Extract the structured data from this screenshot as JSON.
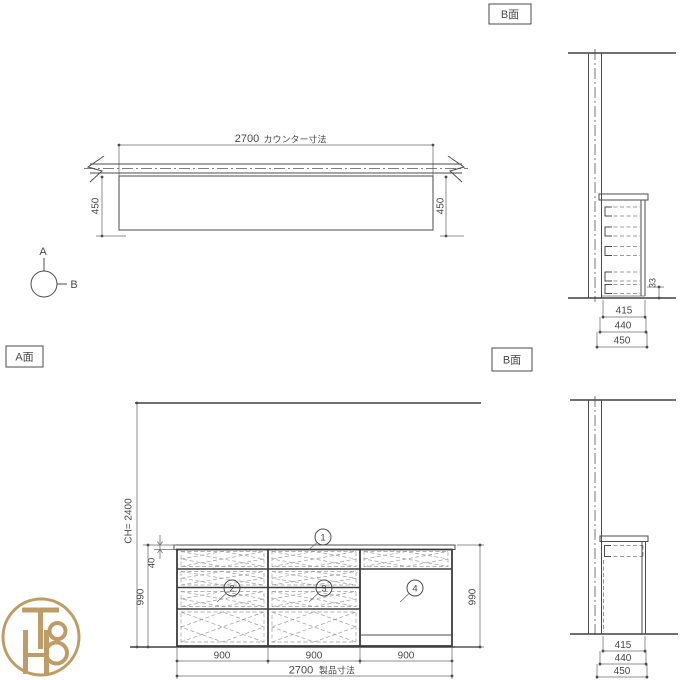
{
  "labels": {
    "a_face": "A面",
    "b_face_top": "B面",
    "b_face_bottom": "B面"
  },
  "orientation_marker": {
    "up": "A",
    "right": "B"
  },
  "plan_view": {
    "total_width": "2700",
    "total_width_note": "カウンター寸法",
    "depth_left": "450",
    "depth_right": "450"
  },
  "section_b_top": {
    "inner_depth": "415",
    "body_depth": "440",
    "total_depth": "450",
    "base_gap": "33"
  },
  "elevation_a": {
    "ceiling_height": "CH= 2400",
    "counter_thickness": "40",
    "height_left": "990",
    "height_right": "990",
    "bay_widths": [
      "900",
      "900",
      "900"
    ],
    "total_width": "2700",
    "total_width_note": "製品寸法",
    "callouts": [
      "1",
      "2",
      "3",
      "4"
    ]
  },
  "section_b_bottom": {
    "inner_depth": "415",
    "body_depth": "440",
    "total_depth": "450"
  },
  "logo": {
    "monogram": "TH8",
    "color": "#bf9c66"
  }
}
